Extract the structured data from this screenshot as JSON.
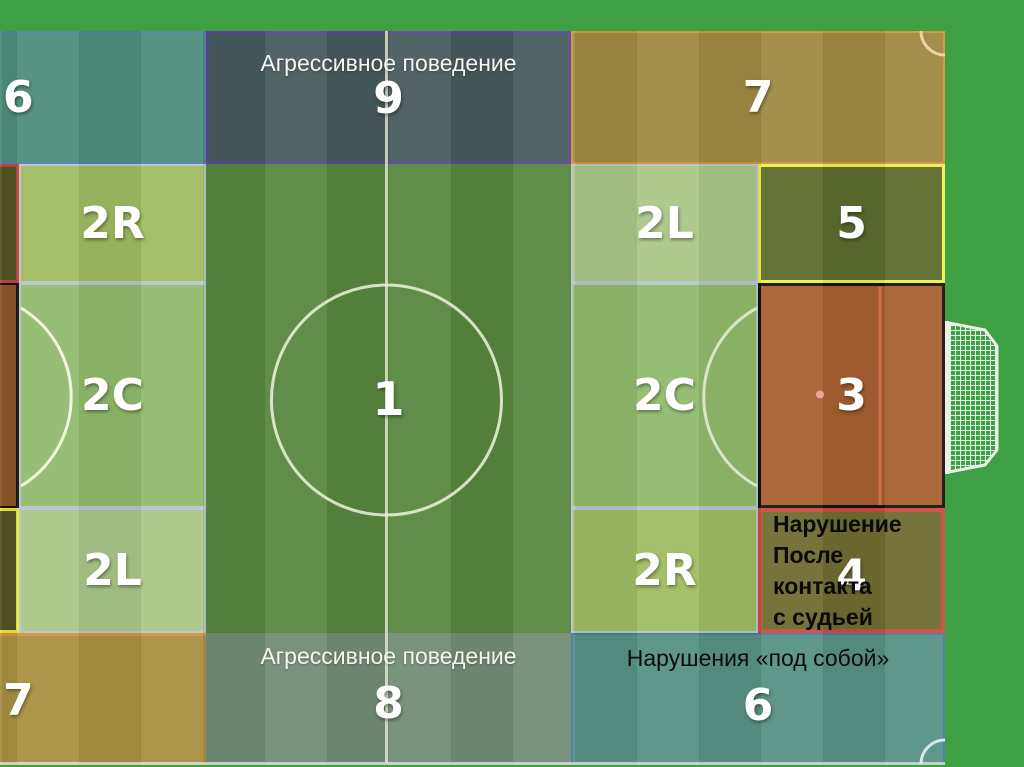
{
  "slide": {
    "zones": {
      "z6_top_left": {
        "number": "6"
      },
      "z9_top_center": {
        "label": "Агрессивное поведение",
        "number": "9"
      },
      "z7_top_right": {
        "number": "7"
      },
      "z2r_upper_left": {
        "number": "2R"
      },
      "z2l_upper_right": {
        "number": "2L"
      },
      "z5_right": {
        "number": "5"
      },
      "z2c_left": {
        "number": "2C"
      },
      "z1_center": {
        "number": "1"
      },
      "z2c_right": {
        "number": "2C"
      },
      "z3_penalty_area": {
        "number": "3"
      },
      "z2l_lower_left": {
        "number": "2L"
      },
      "z2r_lower_right": {
        "number": "2R"
      },
      "z4_right": {
        "number": "4",
        "label": "Нарушение\nПосле контакта\n с судьей"
      },
      "z7_bottom_left": {
        "number": "7"
      },
      "z8_bottom_center": {
        "label": "Агрессивное поведение",
        "number": "8"
      },
      "z6_bottom_right": {
        "label": "Нарушения «под собой»",
        "number": "6"
      }
    },
    "colors": {
      "background": "#3f9f43",
      "z6_top_left": "#4d8d7b",
      "z9_top": "#475a5b",
      "z7_top_right": "#9f8943",
      "z2r": "#a0bb61",
      "z2l": "#aac689",
      "z2c": "#90ba6c",
      "z1": "#578640",
      "z3": "#a55f31",
      "z4": "#6f6c30",
      "z5": "#5c6b2e",
      "z7_bottom_left": "#a98f42",
      "z8_bottom": "#718c76",
      "z6_bottom_right": "#579184",
      "sliver_olive": "#535424",
      "sliver_brown": "#8f562b",
      "border_light_blue": "#5580b0",
      "border_purple": "#584a92",
      "border_orange": "#d8913c",
      "border_yellow": "#eef04a",
      "border_yellow2": "#e8e83c",
      "border_black": "#141414",
      "border_red": "#cf4a3e",
      "border_red2": "#c0453c",
      "border_steel_blue": "#4a79a5",
      "border_gray": "#b6c5ce",
      "pitch_line": "#edf3dd",
      "goal_area_line": "#cc6f4a",
      "penalty_spot": "#f0a292"
    }
  }
}
